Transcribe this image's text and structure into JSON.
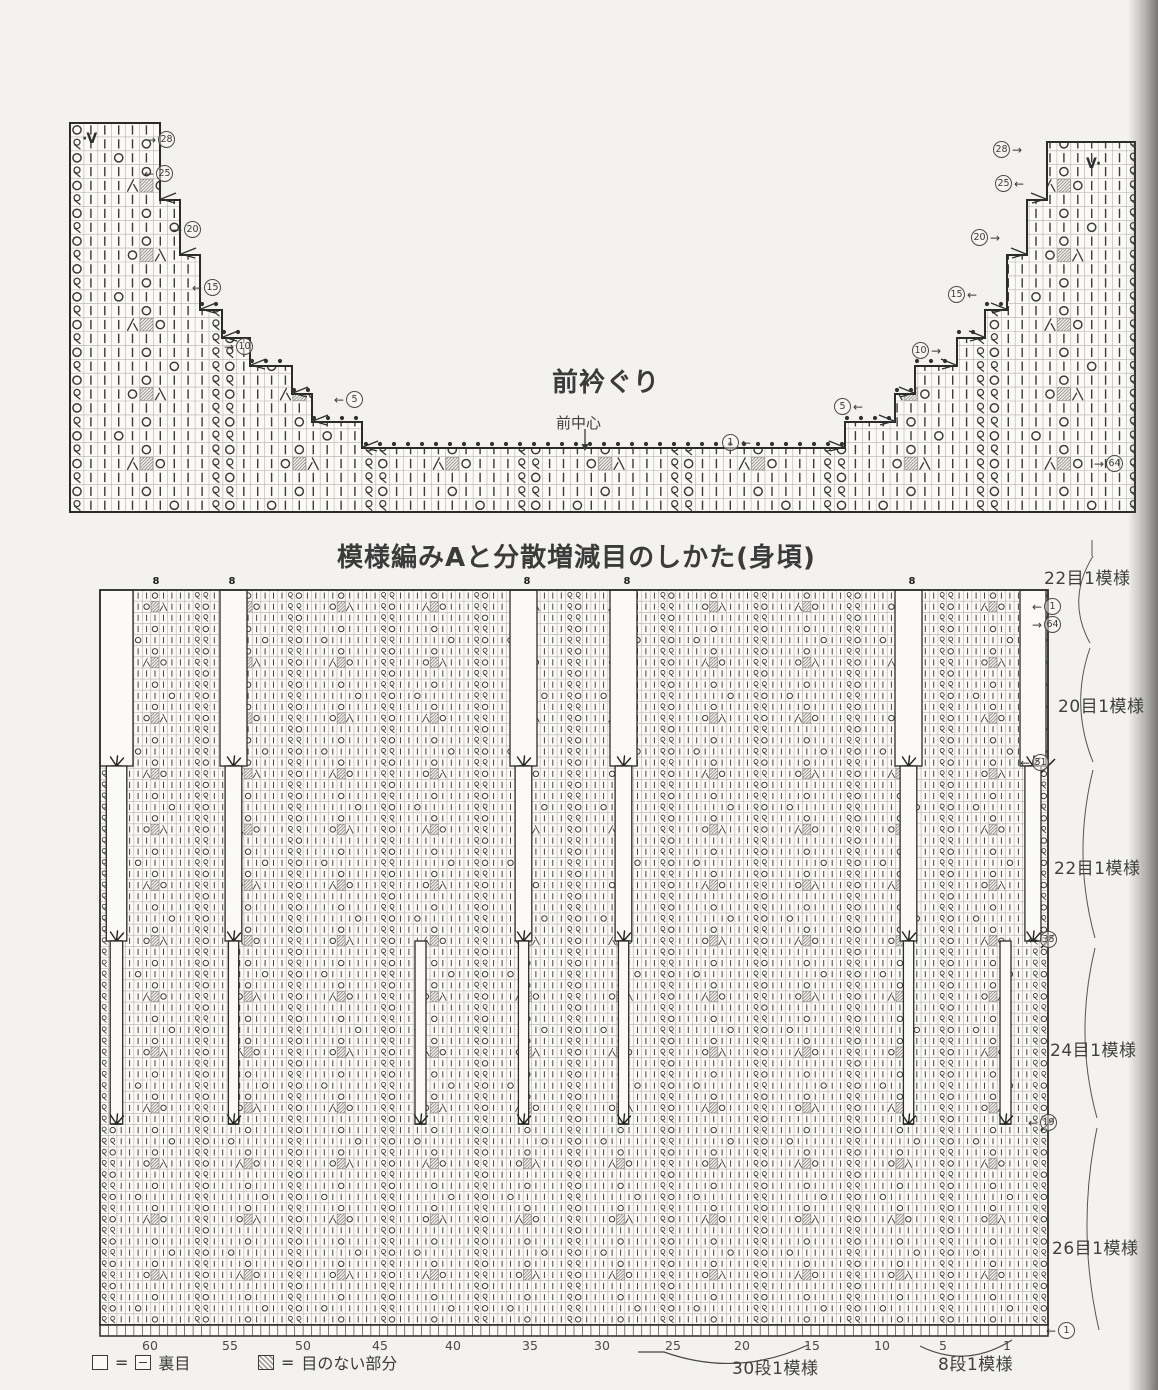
{
  "neckline_section": {
    "title": "前衿ぐり",
    "center_front_label": "前中心",
    "left_v_mark": "·V",
    "right_v_mark": "V·"
  },
  "pattern_section": {
    "title": "模様編みAと分散増減目のしかた(身頃)",
    "right_margin_bracket_labels": [
      "22目1模様",
      "20目1模様",
      "22目1模様",
      "24目1模様",
      "26目1模様"
    ],
    "bottom_stitch_numbers": [
      "60",
      "55",
      "50",
      "45",
      "40",
      "35",
      "30",
      "25",
      "20",
      "15",
      "10",
      "5",
      "1"
    ],
    "brace_labels": [
      "30段1模様",
      "8段1模様"
    ],
    "legend": [
      {
        "symbol": "empty-box-equals-dash-box",
        "label": "裏目"
      },
      {
        "symbol": "hatched-box",
        "label": "目のない部分"
      }
    ],
    "slot_top_mark": "8"
  },
  "chart_spec": {
    "colors": {
      "outline": "#2b2b2b",
      "grid": "#a8a49e",
      "symbol": "#3c3c3c",
      "paper": "#fbfaf7",
      "curve": "#555555"
    },
    "markers": {
      "neckline_left": {
        "items": [
          [
            "→",
            "28"
          ],
          [
            "←",
            "25"
          ],
          [
            "→",
            "20"
          ],
          [
            "←",
            "15"
          ],
          [
            "→",
            "10"
          ],
          [
            "←",
            "5"
          ]
        ],
        "pos": [
          [
            146,
            131
          ],
          [
            144,
            165
          ],
          [
            172,
            221
          ],
          [
            192,
            279
          ],
          [
            224,
            338
          ],
          [
            334,
            391
          ]
        ],
        "order": "af"
      },
      "neckline_right": {
        "items": [
          [
            "→",
            "28"
          ],
          [
            "←",
            "25"
          ],
          [
            "→",
            "20"
          ],
          [
            "←",
            "15"
          ],
          [
            "→",
            "10"
          ],
          [
            "←",
            "5"
          ]
        ],
        "pos": [
          [
            993,
            141
          ],
          [
            995,
            175
          ],
          [
            971,
            229
          ],
          [
            948,
            286
          ],
          [
            912,
            342
          ],
          [
            834,
            398
          ]
        ],
        "order": "cf"
      },
      "neckline_edge": {
        "items": [
          [
            "→",
            "64"
          ]
        ],
        "pos": [
          [
            1094,
            455
          ]
        ],
        "order": "af"
      },
      "neckline_center": {
        "items": [
          [
            "←",
            "1"
          ]
        ],
        "pos": [
          [
            722,
            434
          ]
        ],
        "order": "cf"
      },
      "main_right": {
        "items": [
          [
            "←",
            "1"
          ],
          [
            "→",
            "64"
          ],
          [
            "←",
            "51"
          ],
          [
            "←",
            "35"
          ],
          [
            "←",
            "19"
          ],
          [
            "←",
            "1"
          ]
        ],
        "pos": [
          [
            1032,
            598
          ],
          [
            1032,
            616
          ],
          [
            1020,
            754
          ],
          [
            1028,
            931
          ],
          [
            1028,
            1114
          ],
          [
            1046,
            1322
          ]
        ],
        "order": "af"
      }
    },
    "top_chart": {
      "outline": "M70,123 H160 V200 H180 V255 H200 V310 H222 V338 H250 V366 H292 V394 H312 V422 H362 V448 H845 V422 H895 V394 H915 V366 H957 V338 H985 V310 H1007 V255 H1027 V200 H1047 V142 H1135 V512 H70 Z",
      "x0": 70,
      "y0": 123,
      "x1": 1135,
      "y1": 512,
      "cell": 13.9,
      "dot_rows": [
        [
          304,
          202,
          220
        ],
        [
          332,
          224,
          248
        ],
        [
          361,
          252,
          290
        ],
        [
          390,
          294,
          310
        ],
        [
          418,
          314,
          360
        ],
        [
          444,
          366,
          843
        ],
        [
          418,
          847,
          893
        ],
        [
          390,
          897,
          913
        ],
        [
          361,
          917,
          955
        ],
        [
          332,
          959,
          983
        ],
        [
          304,
          987,
          1005
        ]
      ],
      "corners_left": [
        [
          160,
          200
        ],
        [
          180,
          255
        ],
        [
          200,
          310
        ],
        [
          222,
          338
        ],
        [
          250,
          366
        ],
        [
          292,
          394
        ],
        [
          312,
          422
        ],
        [
          362,
          448
        ]
      ],
      "corners_right": [
        [
          845,
          448
        ],
        [
          895,
          422
        ],
        [
          915,
          394
        ],
        [
          957,
          366
        ],
        [
          985,
          338
        ],
        [
          1007,
          310
        ],
        [
          1027,
          255
        ],
        [
          1047,
          200
        ]
      ],
      "v_marks_pos": [
        [
          82,
          131
        ],
        [
          1086,
          156
        ]
      ],
      "center_arrow": {
        "x": 585,
        "y1": 429,
        "y2": 447
      }
    },
    "main_chart": {
      "x0": 100,
      "y0": 590,
      "x1": 1048,
      "y1": 1325,
      "cols": 112,
      "rows": 66,
      "slot_chains": [
        {
          "x": 100,
          "w": 33,
          "stages": 3
        },
        {
          "x": 220,
          "w": 27,
          "stages": 3
        },
        {
          "x": 510,
          "w": 27,
          "stages": 3
        },
        {
          "x": 610,
          "w": 27,
          "stages": 3
        },
        {
          "x": 895,
          "w": 27,
          "stages": 3
        },
        {
          "x": 1020,
          "w": 26,
          "stages": 2
        }
      ],
      "extra_stage3": [
        {
          "x": 415,
          "w": 11
        },
        {
          "x": 1000,
          "w": 11
        }
      ],
      "stage_y": [
        590,
        766,
        941,
        1124
      ],
      "edge_marks": [
        766,
        941,
        1124
      ],
      "slot_top_marks_x": [
        156,
        232,
        527,
        627,
        912
      ],
      "ruler_h": 11,
      "bottom_numbers_x": [
        150,
        230,
        303,
        380,
        453,
        530,
        602,
        673,
        742,
        812,
        882,
        943,
        1007
      ],
      "bracket_pos": [
        [
          1044,
          564
        ],
        [
          1058,
          692
        ],
        [
          1054,
          854
        ],
        [
          1050,
          1036
        ],
        [
          1052,
          1234
        ]
      ],
      "margin_curves": [
        "M1092,540 L1092,556",
        "M1093,556 Q1066,600 1090,643",
        "M1090,648 Q1070,705 1093,762",
        "M1093,770 Q1072,855 1095,938",
        "M1095,948 Q1074,1035 1097,1118",
        "M1097,1128 Q1076,1230 1099,1330"
      ],
      "brace_paths": [
        "M638,1352 L664,1352 Q737,1378 808,1345",
        "M920,1346 Q966,1369 1012,1340"
      ],
      "brace_label_pos": [
        [
          732,
          1354
        ],
        [
          938,
          1350
        ]
      ]
    },
    "pattern_unit": {
      "motif": [
        "|||O|||",
        "||O#A||",
        "|||||||",
        "|||O|||",
        "|O|||||",
        "|||O|||",
        "||V#O||",
        "|||||||",
        "|||O|||",
        "|||||O|"
      ],
      "period": 10,
      "unit_cols": 22
    }
  }
}
